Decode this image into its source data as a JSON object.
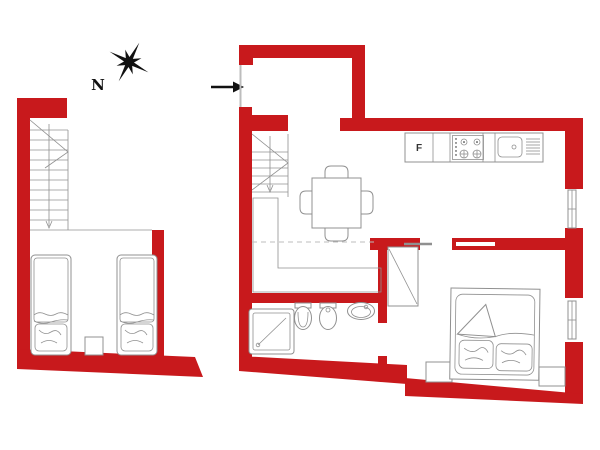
{
  "colors": {
    "wall": "#c8191c",
    "line": "#909090",
    "line-light": "#bdbdbd",
    "ink": "#111111",
    "paper": "#ffffff"
  },
  "labels": {
    "compass_north": "N",
    "kitchen_fridge": "F"
  },
  "icons": {
    "compass": "eight-point-compass-rose",
    "entrance": "right-arrow"
  },
  "units": [
    {
      "name": "left-unit",
      "features": [
        "staircase",
        "single-bed",
        "single-bed",
        "nightstand"
      ]
    },
    {
      "name": "right-unit",
      "features": [
        "entry-vestibule",
        "entrance-door",
        "staircase",
        "kitchen-counter",
        "fridge",
        "hob",
        "kitchen-sink",
        "dining-table",
        "chairs",
        "mezzanine-edge",
        "shower",
        "toilet",
        "bidet",
        "washbasin",
        "wardrobe",
        "sliding-door",
        "double-bed",
        "nightstand",
        "nightstand",
        "window",
        "window"
      ]
    }
  ]
}
